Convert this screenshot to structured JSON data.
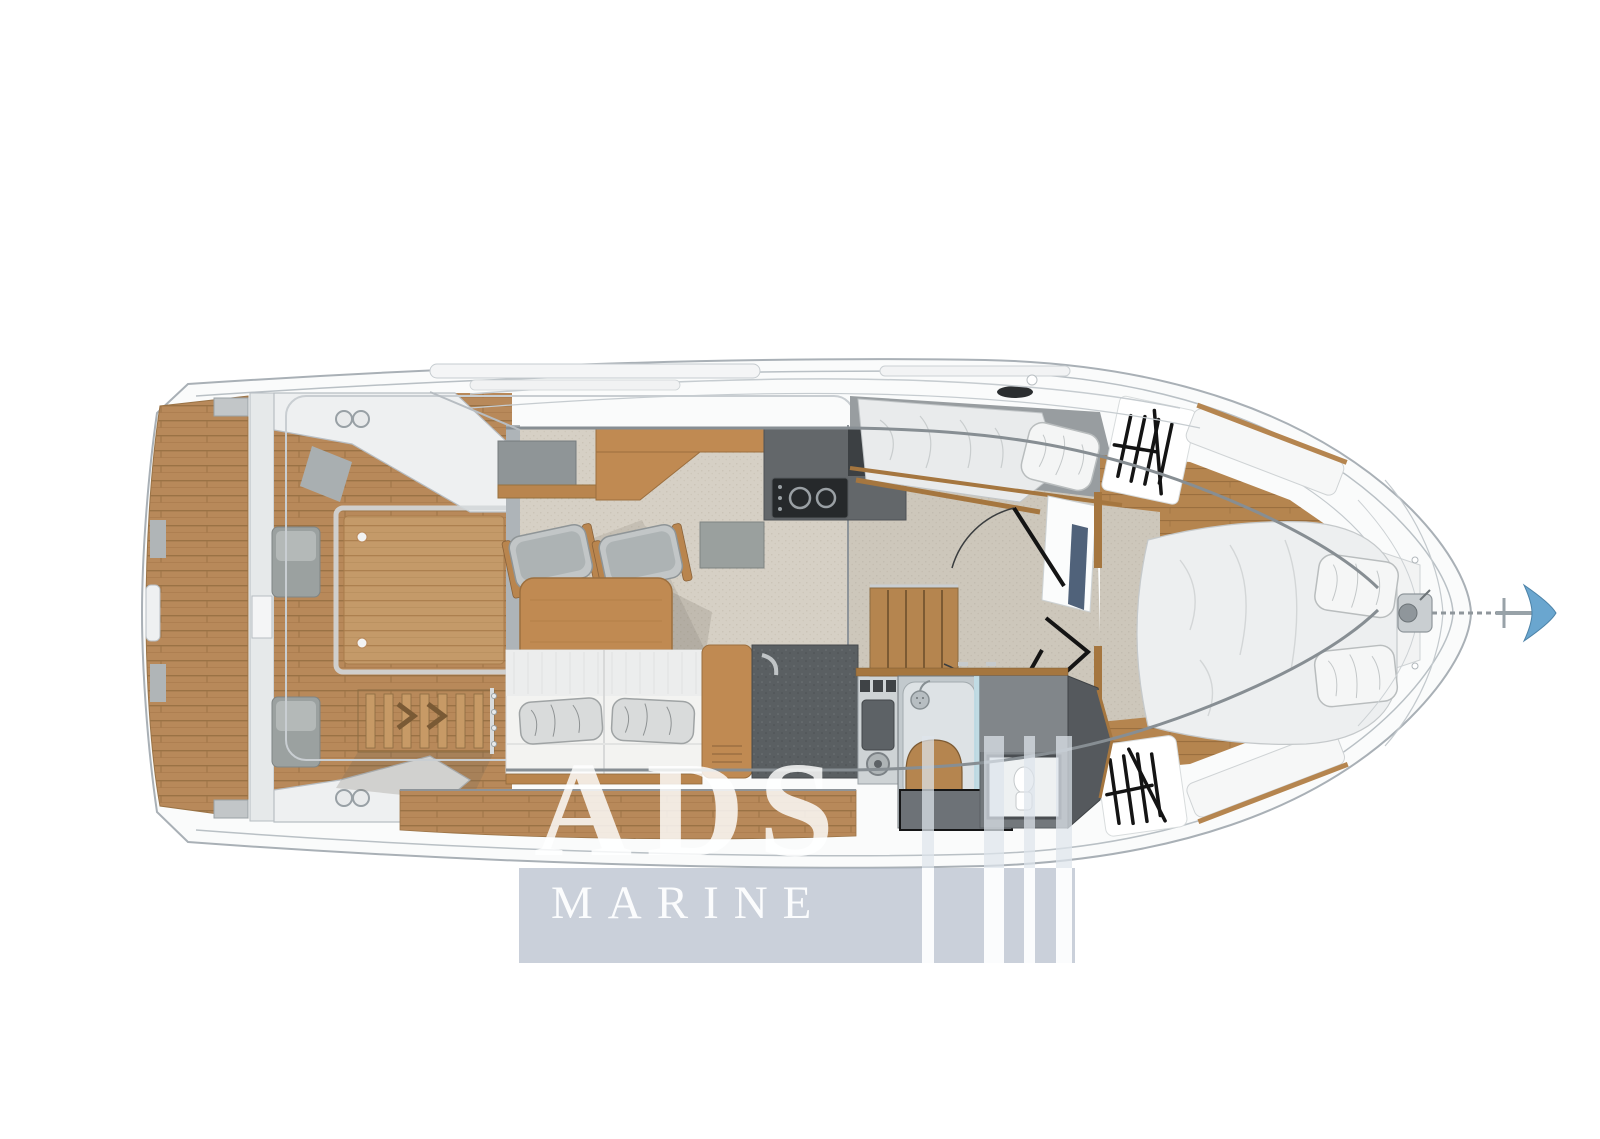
{
  "watermark": {
    "title": "ADS",
    "subtitle": "MARINE",
    "text_color": "#ffffff",
    "box_color": "rgba(170,179,195,0.62)"
  },
  "palette": {
    "page_bg": "#ffffff",
    "hull_fill": "#fafbfb",
    "hull_line": "#a9b0b6",
    "teak_deck": "#b8895a",
    "teak_seam": "#9a7245",
    "furniture_wood": "#c08a52",
    "cabin_floor_wood": "#b5854f",
    "wood_trim": "#a5763f",
    "salon_carpet": "#d6d0c5",
    "cabin_carpet": "#cdc7bb",
    "counter_dark": "#63676a",
    "stove_black": "#26292b",
    "upholstery_gray": "#9fa6a8",
    "bedding_white": "#edeff0",
    "hatch_white": "#ffffff",
    "hatch_marks": "#141414",
    "door_black": "#141414",
    "shower_glass_blue": "#bfe0ea",
    "anchor_blue": "#6aa6cf"
  }
}
